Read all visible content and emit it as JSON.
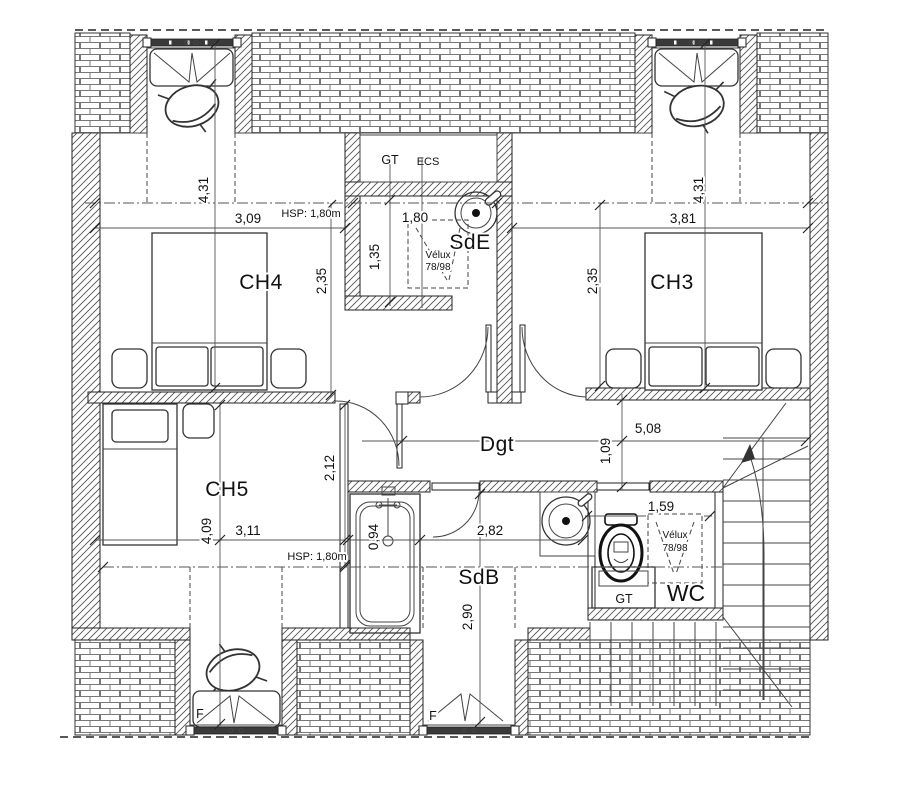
{
  "colors": {
    "line": "#222222",
    "background": "#ffffff",
    "text": "#111111"
  },
  "rooms": {
    "ch4": "CH4",
    "ch3": "CH3",
    "ch5": "CH5",
    "sde": "SdE",
    "sdb": "SdB",
    "dgt": "Dgt",
    "wc": "WC",
    "gt_top": "GT",
    "ecs": "ECS",
    "gt_wc": "GT"
  },
  "dims": {
    "ch4_depth": "4,31",
    "ch4_width": "3,09",
    "ch4_side": "2,35",
    "sde_width": "1,80",
    "sde_depth": "1,35",
    "ch3_depth": "4,31",
    "ch3_width": "3,81",
    "ch3_side": "2,35",
    "ch5_wall": "2,12",
    "ch5_depth": "4,09",
    "ch5_width": "3,11",
    "tub_width": "0,94",
    "sdb_width": "2,82",
    "sdb_depth": "2,90",
    "dgt_length": "5,08",
    "dgt_width": "1,09",
    "wc_width": "1,59"
  },
  "notes": {
    "hsp_top": "HSP: 1,80m",
    "hsp_bottom": "HSP: 1,80m",
    "velux_sde_line1": "Vélux",
    "velux_sde_line2": "78/98",
    "velux_wc_line1": "Vélux",
    "velux_wc_line2": "78/98",
    "window_left": "F",
    "window_mid": "F"
  }
}
